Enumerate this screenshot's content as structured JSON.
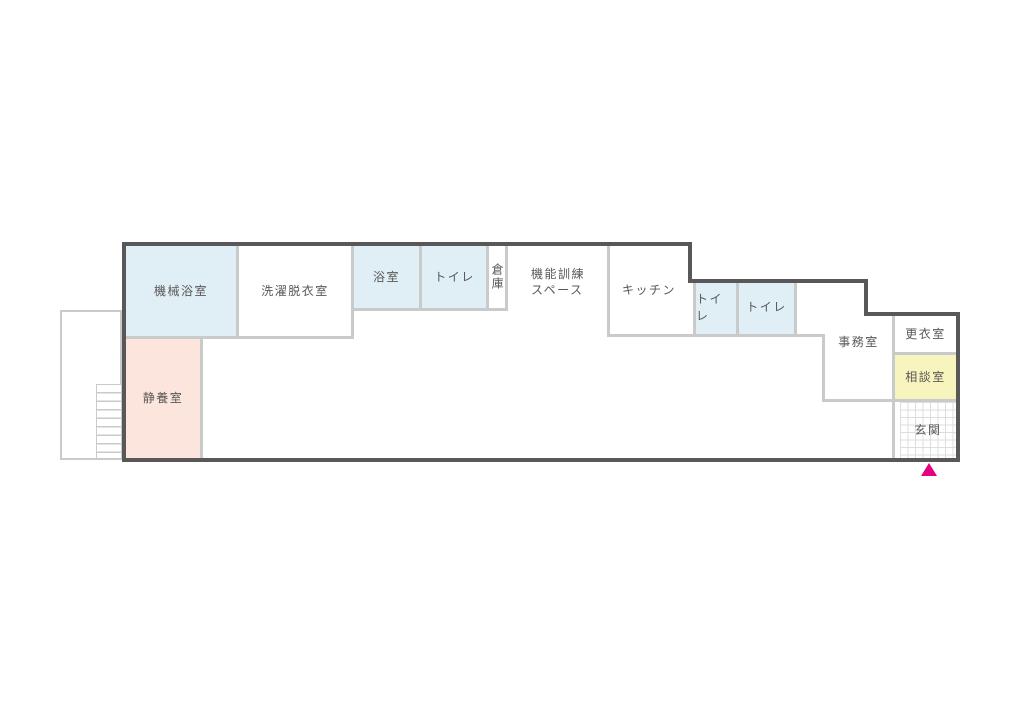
{
  "rooms": {
    "machine_bath": "機械浴室",
    "laundry": "洗濯脱衣室",
    "bath": "浴室",
    "toilet_top": "トイレ",
    "storage": "倉庫",
    "training_space": "機能訓練\nスペース",
    "kitchen": "キッチン",
    "toilet_right_1": "トイレ",
    "toilet_right_2": "トイレ",
    "office": "事務室",
    "changing_room": "更衣室",
    "consultation_room": "相談室",
    "entrance": "玄関",
    "rest_room": "静養室"
  },
  "colors": {
    "wall_dark": "#595757",
    "wall_light": "#c9caca",
    "room_blue": "#e0eef5",
    "room_pink": "#fce5dd",
    "room_yellow": "#f8f4bd",
    "entrance_marker": "#e4007f",
    "label_text": "#595757"
  }
}
